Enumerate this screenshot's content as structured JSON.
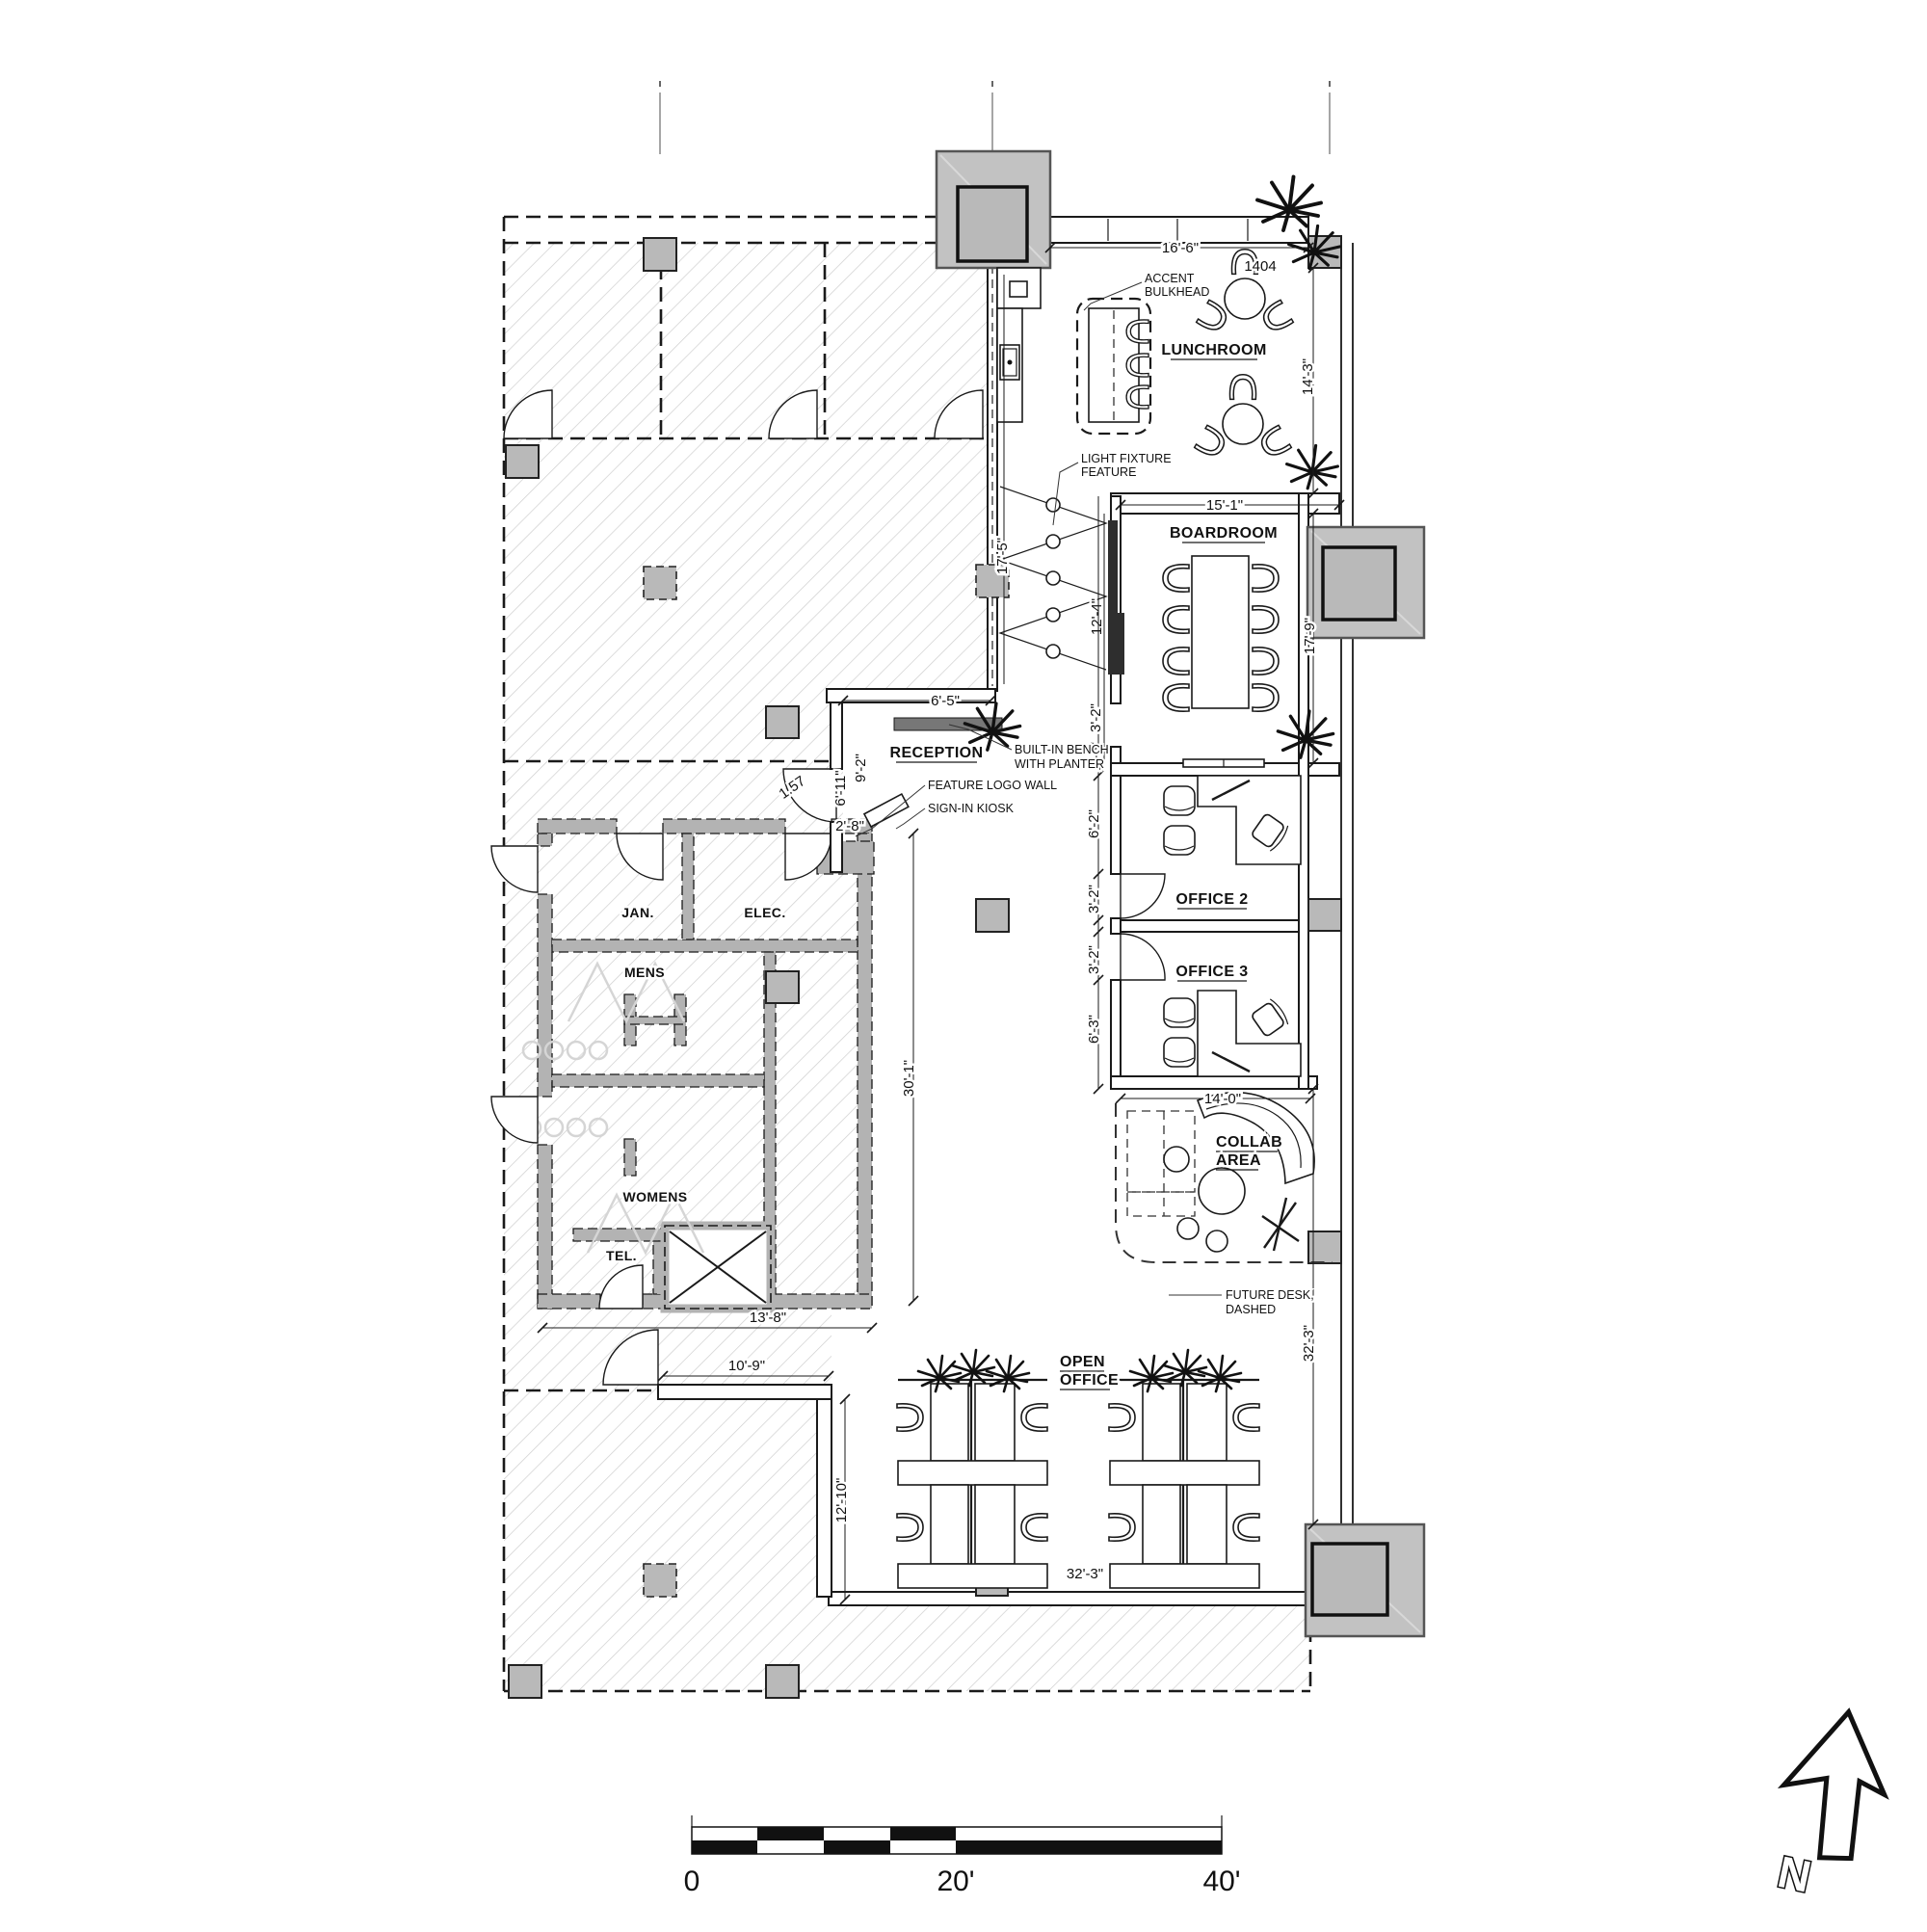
{
  "rooms": {
    "lunchroom": "LUNCHROOM",
    "boardroom": "BOARDROOM",
    "reception": "RECEPTION",
    "office2": "OFFICE 2",
    "office3": "OFFICE 3",
    "collab1": "COLLAB",
    "collab2": "AREA",
    "open1": "OPEN",
    "open2": "OFFICE",
    "jan": "JAN.",
    "elec": "ELEC.",
    "mens": "MENS",
    "womens": "WOMENS",
    "tel": "TEL."
  },
  "dims": {
    "lunch_w": "16'-6\"",
    "lunch_d": "14'-3\"",
    "board_w": "15'-1\"",
    "board_d": "12'-4\"",
    "board_d2": "17'-9\"",
    "corr": "17'-5\"",
    "recep_w": "6'-5\"",
    "recep_a": "6'-11\"",
    "recep_b": "9'-2\"",
    "recep_c": "2'-8\"",
    "artifact": "1.57",
    "bench_a": "3'-2\"",
    "bench_b": "1'-6\"",
    "off2_a": "6'-2\"",
    "off2_door": "3'-2\"",
    "off3_door": "3'-2\"",
    "off3_a": "6'-3\"",
    "collab_w": "14'-0\"",
    "right_v": "32'-3\"",
    "corridor_v": "30'-1\"",
    "wash_w": "13'-8\"",
    "entry_w": "10'-9\"",
    "entry_d": "12'-10\"",
    "open_w": "32'-3\"",
    "tag": "1404"
  },
  "ann": {
    "accent1": "ACCENT",
    "accent2": "BULKHEAD",
    "light1": "LIGHT FIXTURE",
    "light2": "FEATURE",
    "bench1": "BUILT-IN BENCH",
    "bench2": "WITH PLANTER",
    "logo": "FEATURE LOGO WALL",
    "kiosk": "SIGN-IN KIOSK",
    "future1": "FUTURE DESK,",
    "future2": "DASHED"
  },
  "scale_bar": {
    "zero": "0",
    "mid": "20'",
    "end": "40'"
  },
  "north": {
    "label": "N"
  },
  "colors": {
    "line": "#1a1a1a",
    "hatch": "#cfcfcf",
    "column": "#b9b9b9",
    "wall_gray": "#b3b3b3"
  }
}
